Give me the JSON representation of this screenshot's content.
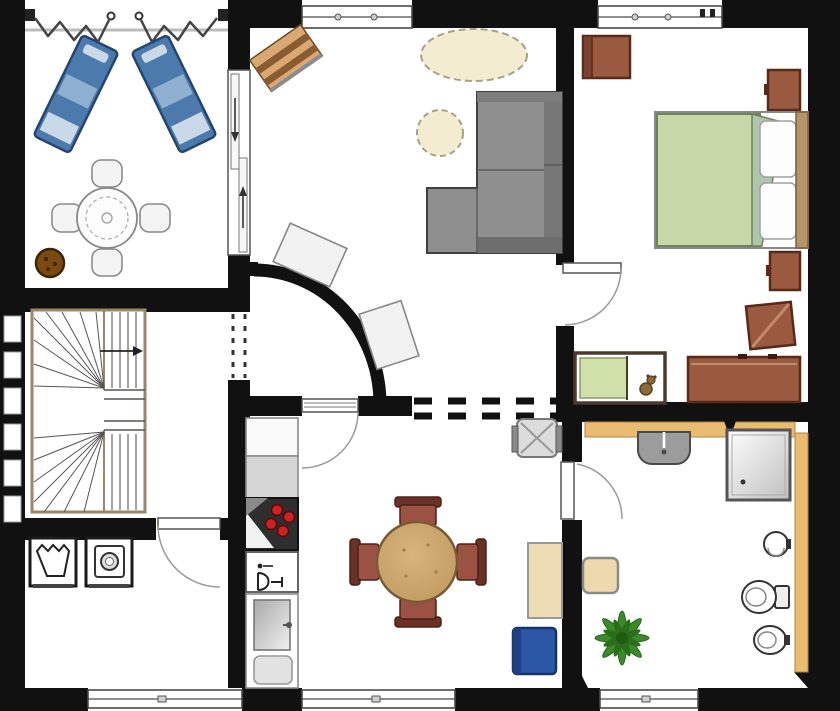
{
  "app": {
    "type": "architectural-floor-plan",
    "text_labels": []
  },
  "rooms": [
    {
      "id": "terrace",
      "items": [
        "awning-hooks",
        "awning-zigzag-left",
        "awning-zigzag-right",
        "sun-lounger-left",
        "sun-lounger-right",
        "round-table",
        "terrace-chair x4",
        "plant-pot"
      ]
    },
    {
      "id": "living-room",
      "items": [
        "wooden-sideboard",
        "oval-rug",
        "round-pouf",
        "corner-sofa",
        "wall-panel x2",
        "curved-wall",
        "sliding-terrace-door",
        "door-to-kitchen",
        "dashed-opening-to-stair-hall",
        "dashed-opening-to-kitchen",
        "top-window"
      ]
    },
    {
      "id": "bedroom",
      "items": [
        "dresser",
        "nightstand-top",
        "double-bed",
        "pillows x2",
        "open-wardrobe",
        "nightstand-bottom",
        "long-sideboard",
        "crib-with-teddy",
        "bedroom-door",
        "top-window"
      ]
    },
    {
      "id": "stair-hall",
      "items": [
        "winder-staircase",
        "up-direction-arrow",
        "glass-block-wall"
      ]
    },
    {
      "id": "utility-room",
      "items": [
        "laundry-tub",
        "washing-machine",
        "utility-door",
        "bottom-window"
      ]
    },
    {
      "id": "kitchen-dining",
      "items": [
        "tall-cabinet",
        "worktop",
        "corner-stove",
        "dishwasher",
        "double-sink",
        "round-dining-table",
        "dining-chair x4",
        "high-chair",
        "side-cabinet",
        "blue-bin",
        "bottom-window"
      ]
    },
    {
      "id": "bathroom",
      "items": [
        "wash-basin",
        "shower",
        "hand-basin",
        "toilet",
        "bidet",
        "stool",
        "plant",
        "tiled-ledge-top",
        "tiled-ledge-right",
        "bathroom-door",
        "bottom-window"
      ]
    }
  ],
  "colors": {
    "wall": "#111111",
    "lounger_blue": "#4d7aad",
    "lounger_blue_light": "#8fb0d0",
    "lounger_pale": "#c9d9e8",
    "wood_sideboard": "#d9a873",
    "wood_stripe": "#8a5a30",
    "rug_cream": "#f4ecd0",
    "sofa_gray": "#8f8f8f",
    "sofa_dark": "#6e6e6e",
    "duvet_green": "#c8d8a8",
    "sheet_fold": "#aec6ae",
    "furniture_brown": "#9a5a40",
    "furniture_brown_dark": "#5a2a18",
    "crib_green": "#cfe0a8",
    "table_wood": "#c9a169",
    "chair_red_brown": "#9c5243",
    "chair_dark": "#6a3226",
    "tile_tan": "#eabc72",
    "stool_tan": "#edd9ad",
    "bin_blue": "#2c57a7",
    "plant_green": "#3a8a2a",
    "stove_red": "#cc2222",
    "pot_brown": "#7a4a10",
    "stair_wood": "#9a8668"
  }
}
